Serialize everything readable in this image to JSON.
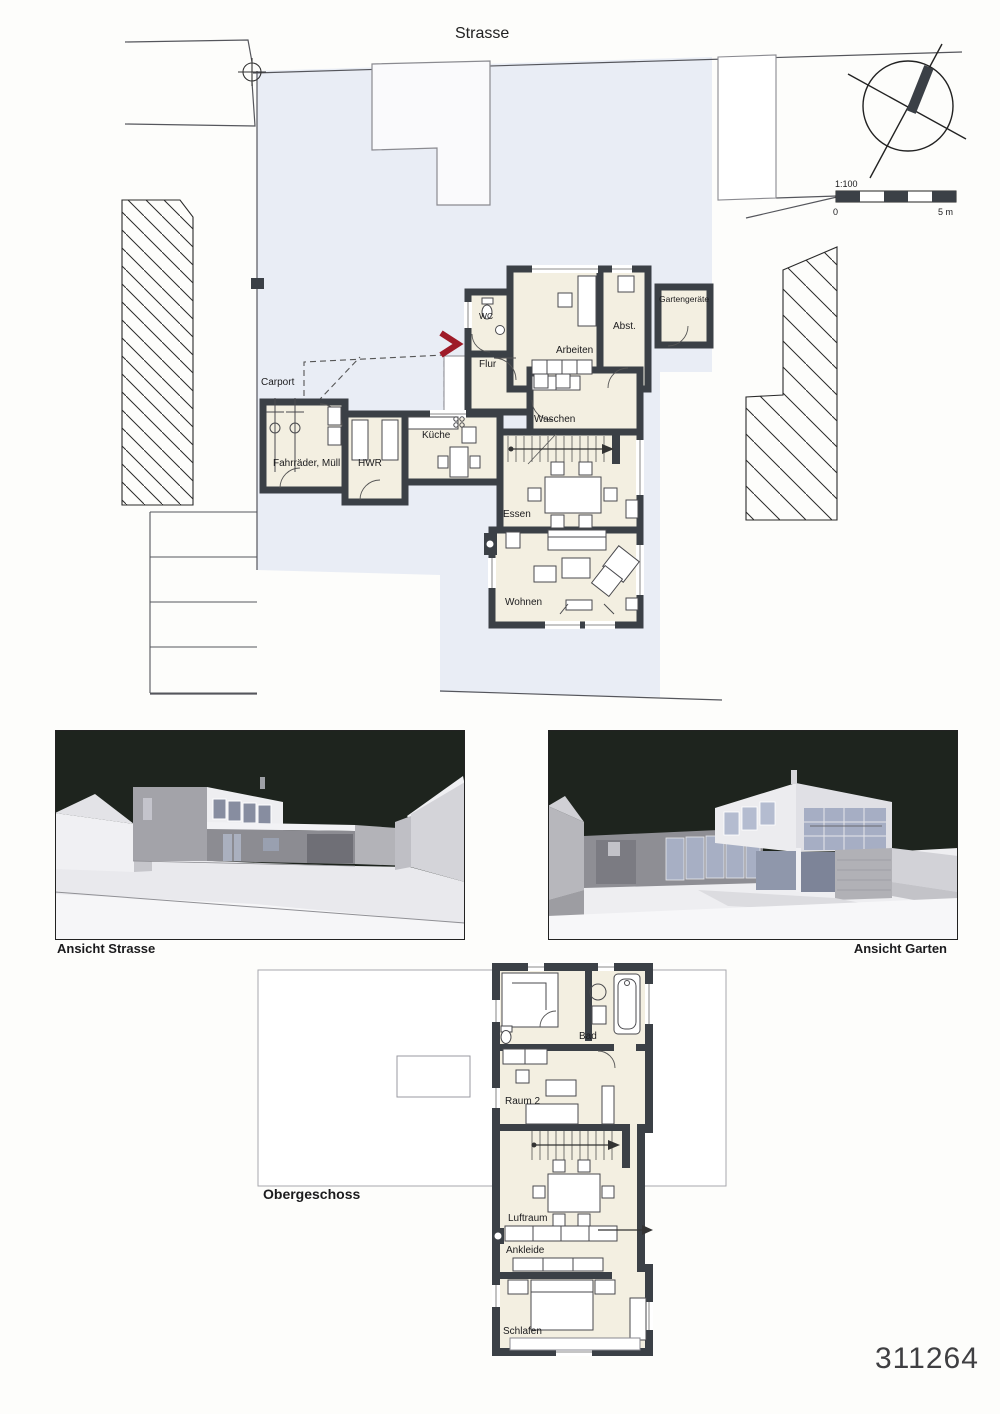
{
  "sheet": {
    "number": "311264"
  },
  "site": {
    "street_label": "Strasse"
  },
  "scale_bar": {
    "ratio": "1:100",
    "start": "0",
    "end": "5 m"
  },
  "ground_floor": {
    "rooms": {
      "carport": "Carport",
      "bikes": "Fahrräder, Müll",
      "utility": "HWR",
      "kitchen": "Küche",
      "laundry": "Waschen",
      "hall": "Flur",
      "wc": "WC",
      "office": "Arbeiten",
      "storage": "Abst.",
      "garden_shed": "Gartengeräte",
      "dining": "Essen",
      "living": "Wohnen"
    }
  },
  "views": {
    "street": "Ansicht Strasse",
    "garden": "Ansicht Garten"
  },
  "upper_floor": {
    "title": "Obergeschoss",
    "rooms": {
      "bath": "Bad",
      "room2": "Raum 2",
      "void": "Luftraum",
      "dressing": "Ankleide",
      "sleeping": "Schlafen"
    }
  },
  "colors": {
    "wall": "#3b4046",
    "room_fill": "#f3efe1",
    "paving": "#e9edf5",
    "accent_red": "#9e1b28",
    "render_sky": "#1e241e"
  }
}
